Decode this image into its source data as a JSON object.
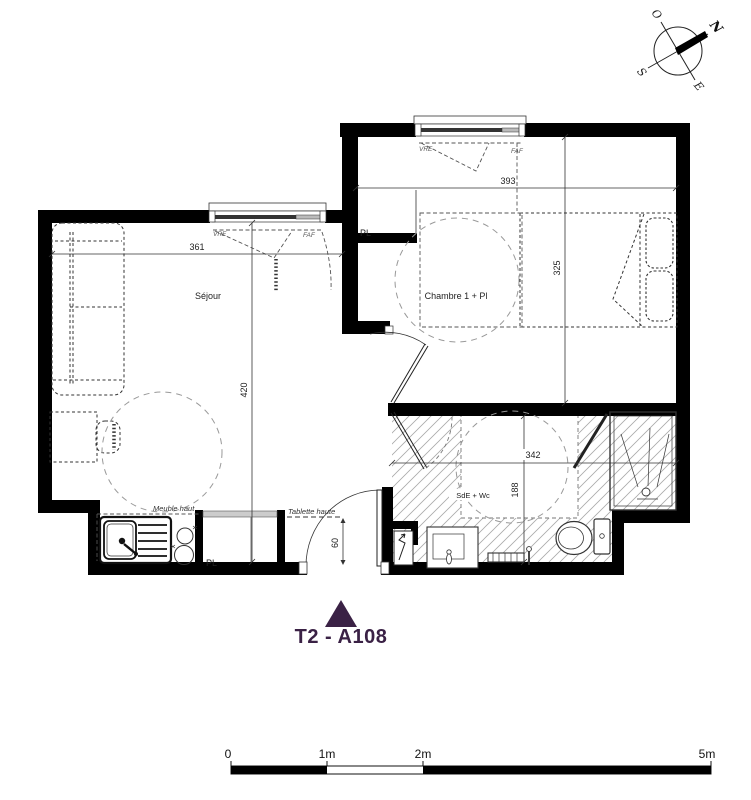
{
  "title": {
    "label": "T2 - A108"
  },
  "compass": {
    "north": "N",
    "south": "S",
    "east": "E",
    "west": "O"
  },
  "rooms": {
    "sejour": {
      "name": "Séjour",
      "width": "361",
      "height": "420"
    },
    "chambre": {
      "name": "Chambre 1 + Pl",
      "width": "393",
      "height": "325"
    },
    "sde": {
      "name": "SdE + Wc",
      "width": "342",
      "height": "188"
    }
  },
  "labels": {
    "closet_top": "PL",
    "closet_bottom": "PL",
    "high_cabinet": "Meuble haut",
    "high_shelf": "Tablette haute",
    "door_clearance": "60",
    "window_sejour_vre": "VRE",
    "window_sejour_faf": "FAF",
    "window_chambre_vre": "VRE",
    "window_chambre_faf": "FAF"
  },
  "scale_bar": {
    "t0": "0",
    "t1": "1m",
    "t2": "2m",
    "t5": "5m"
  },
  "colors": {
    "accent": "#3A2145",
    "wall": "#000000",
    "line": "#333333",
    "hatch": "#AAAAAA"
  }
}
